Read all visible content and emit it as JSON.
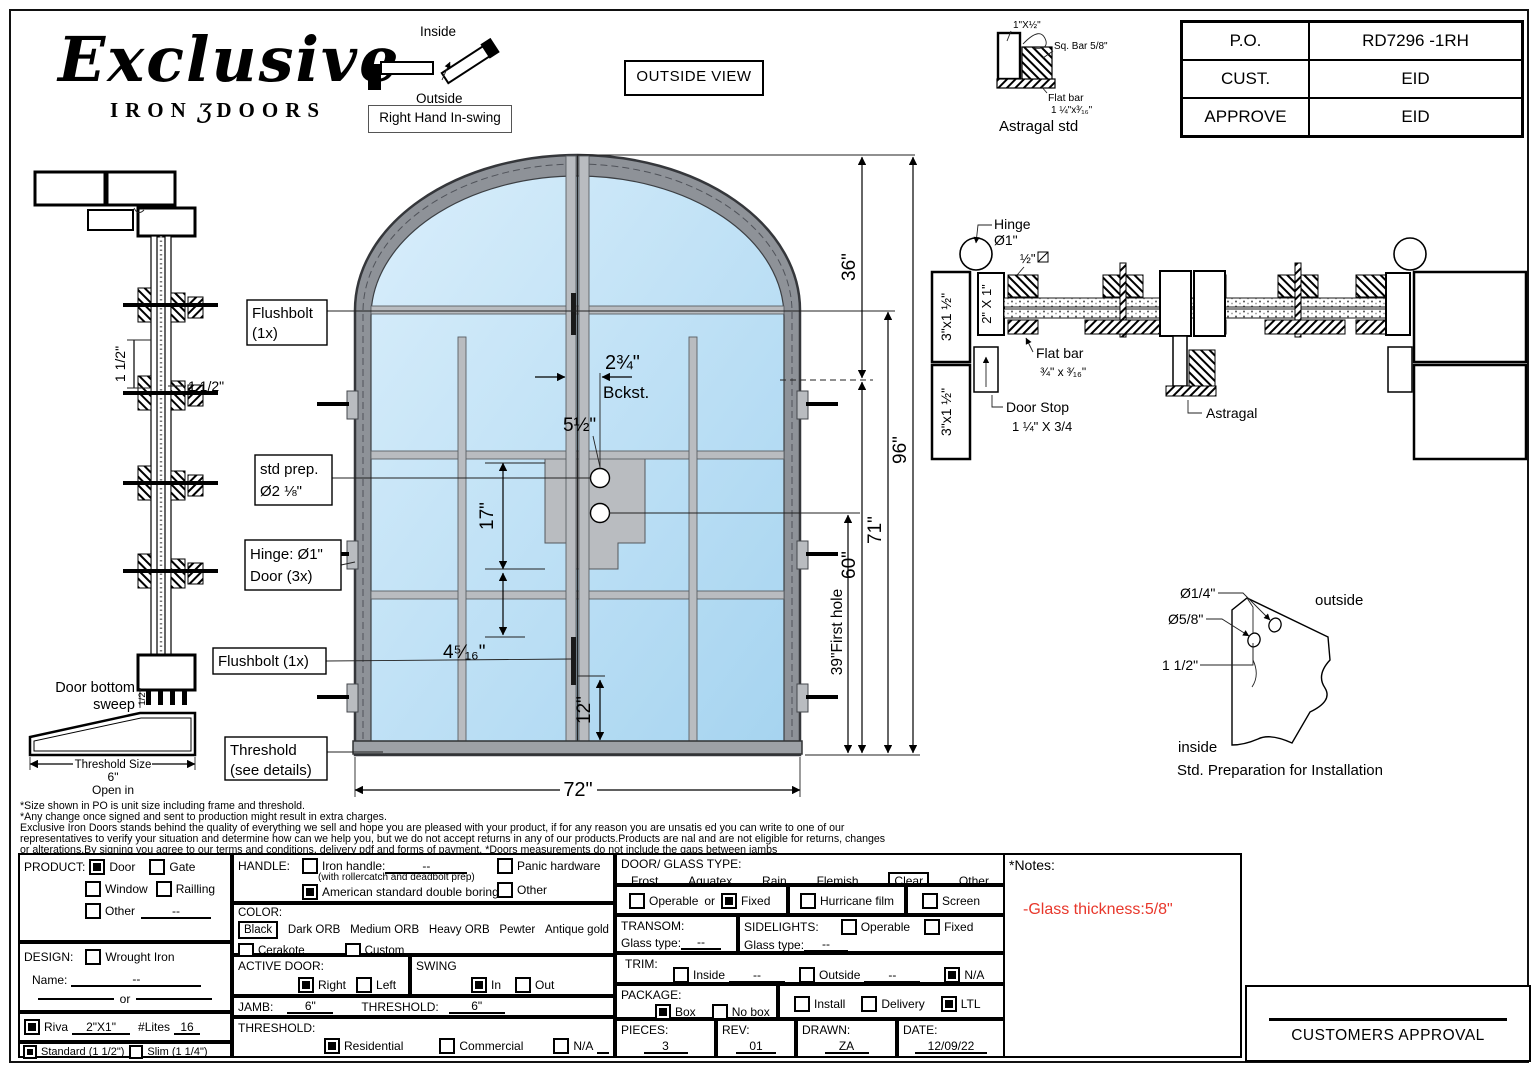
{
  "logo": {
    "script": "Exclusive",
    "iron": "IRON",
    "doors": "DOORS",
    "ornament": "ʒ"
  },
  "swing_diagram": {
    "inside": "Inside",
    "outside": "Outside",
    "caption": "Right Hand In-swing"
  },
  "view_label": "OUTSIDE VIEW",
  "astragal_detail": {
    "dim": "1\"X½\"",
    "sqbar": "Sq. Bar 5/8\"",
    "flat1": "Flat bar",
    "flat2": "1 ¼\"x³⁄₁₆\"",
    "caption": "Astragal std"
  },
  "po": [
    {
      "label": "P.O.",
      "value": "RD7296 -1RH"
    },
    {
      "label": "CUST.",
      "value": "EID"
    },
    {
      "label": "APPROVE",
      "value": "EID"
    }
  ],
  "door": {
    "flushbolt1a": "Flushbolt",
    "flushbolt1b": "(1x)",
    "stdprep1": "std prep.",
    "stdprep2": "Ø2 ⅛\"",
    "hinge1": "Hinge: Ø1\"",
    "hinge2": "Door (3x)",
    "flushbolt2": "Flushbolt (1x)",
    "thr1": "Threshold",
    "thr2": "(see details)",
    "bckst_num": "2¾\"",
    "bckst": "Bckst.",
    "d5": "5½\"",
    "d17": "17\"",
    "d4516": "4⁵⁄₁₆\"",
    "d12": "12\"",
    "d72": "72\"",
    "d36": "36\"",
    "d60": "60\"",
    "d71": "71\"",
    "d96": "96\"",
    "d39": "39\"First hole"
  },
  "profile": {
    "d15v": "1 1/2\"",
    "d15h": "1 1/2\"",
    "sweep1": "Door bottom",
    "sweep2": "sweep",
    "half": "1/2",
    "thr1": "Threshold Size",
    "thr2": "6\"",
    "thr3": "Open in"
  },
  "xsec": {
    "hinge1": "Hinge",
    "hinge2": "Ø1\"",
    "half": "½\"",
    "jamb": "3\"x1 ½\"",
    "leaf": "2\" X 1\"",
    "flat1": "Flat bar",
    "flat2": "¾\" x ³⁄₁₆\"",
    "stop1": "Door Stop",
    "stop2": "1 ¼\" X 3/4",
    "astragal": "Astragal"
  },
  "install": {
    "d14": "Ø1/4\"",
    "d58": "Ø5/8\"",
    "d112": "1 1/2\"",
    "outside": "outside",
    "inside": "inside",
    "caption": "Std. Preparation for Installation"
  },
  "disclaimer": [
    "*Size shown in PO is unit size including frame and threshold.",
    "*Any change once signed and sent to production might result in extra charges.",
    "Exclusive Iron Doors stands behind the quality of everything we sell and hope you are pleased with your product, if for any reason you are unsatis ed you can write to one of our",
    "representatives to verify your situation and determine how can we help you, but we do not accept returns in any of our products.Products are  nal and are not eligible for returns, changes",
    "or alterations.By signing you agree to our terms and conditions, delivery pdf and forms of payment. *Doors measurements do not include the gaps between jambs"
  ],
  "form": {
    "product": {
      "title": "PRODUCT:",
      "door": "Door",
      "gate": "Gate",
      "window": "Window",
      "railling": "Railling",
      "other": "Other",
      "other_val": "--",
      "checked": [
        "Door"
      ]
    },
    "design": {
      "title": "DESIGN:",
      "wrought": "Wrought Iron",
      "name_label": "Name:",
      "name_val": "--",
      "or": "or"
    },
    "riva": {
      "label": "Riva",
      "size": "2\"X1\"",
      "lites_label": "#Lites",
      "lites_val": "16",
      "checked": true
    },
    "frame": {
      "standard": "Standard (1 1/2\")",
      "slim": "Slim (1 1/4\")",
      "checked": [
        "Standard (1 1/2\")"
      ]
    },
    "handle": {
      "title": "HANDLE:",
      "iron": "Iron handle:",
      "iron_val": "--",
      "iron_sub": "(with rollercatch and deadbolt prep)",
      "american": "American standard double boring",
      "panic": "Panic hardware",
      "other": "Other",
      "checked": [
        "American standard double boring"
      ]
    },
    "color": {
      "title": "COLOR:",
      "black": "Black",
      "dark": "Dark ORB",
      "medium": "Medium ORB",
      "heavy": "Heavy ORB",
      "pewter": "Pewter",
      "antique": "Antique gold",
      "cerakote": "Cerakote",
      "custom": "Custom",
      "selected": "Black"
    },
    "active": {
      "title": "ACTIVE DOOR:",
      "right": "Right",
      "left": "Left",
      "checked": "Right"
    },
    "swing": {
      "title": "SWING",
      "in": "In",
      "out": "Out",
      "checked": "In"
    },
    "jamb": {
      "title": "JAMB:",
      "value": "6\"",
      "thr_title": "THRESHOLD:",
      "thr_value": "6\""
    },
    "threshold": {
      "title": "THRESHOLD:",
      "residential": "Residential",
      "commercial": "Commercial",
      "na": "N/A",
      "checked": "Residential"
    },
    "glass": {
      "title": "DOOR/ GLASS TYPE:",
      "frost": "Frost",
      "aquatex": "Aquatex",
      "rain": "Rain",
      "flemish": "Flemish",
      "clear": "Clear",
      "other": "Other",
      "selected": "Clear"
    },
    "fixedrow": {
      "operable": "Operable",
      "or": "or",
      "fixed": "Fixed",
      "hurricane": "Hurricane film",
      "screen": "Screen",
      "checked": "Fixed"
    },
    "transom": {
      "title": "TRANSOM:",
      "glass_label": "Glass type:",
      "value": "--"
    },
    "sidelights": {
      "title": "SIDELIGHTS:",
      "glass_label": "Glass type:",
      "value": "--",
      "operable": "Operable",
      "fixed": "Fixed"
    },
    "trim": {
      "title": "TRIM:",
      "inside": "Inside",
      "inside_val": "--",
      "outside": "Outside",
      "outside_val": "--",
      "na": "N/A",
      "checked": "N/A"
    },
    "package": {
      "title": "PACKAGE:",
      "box": "Box",
      "nobox": "No box",
      "install": "Install",
      "delivery": "Delivery",
      "ltl": "LTL",
      "checked": [
        "Box",
        "LTL"
      ]
    },
    "meta": {
      "pieces_label": "PIECES:",
      "pieces": "3",
      "rev_label": "REV:",
      "rev": "01",
      "drawn_label": "DRAWN:",
      "drawn": "ZA",
      "date_label": "DATE:",
      "date": "12/09/22"
    }
  },
  "notes": {
    "title": "*Notes:",
    "body": "-Glass thickness:5/8\"",
    "accent": "#e8372b"
  },
  "approval_label": "CUSTOMERS APPROVAL",
  "colors": {
    "glass_light": "#d9eefb",
    "glass_dark": "#a6d4f0",
    "frame": "#8e9298",
    "bars": "#b9bcc0"
  }
}
